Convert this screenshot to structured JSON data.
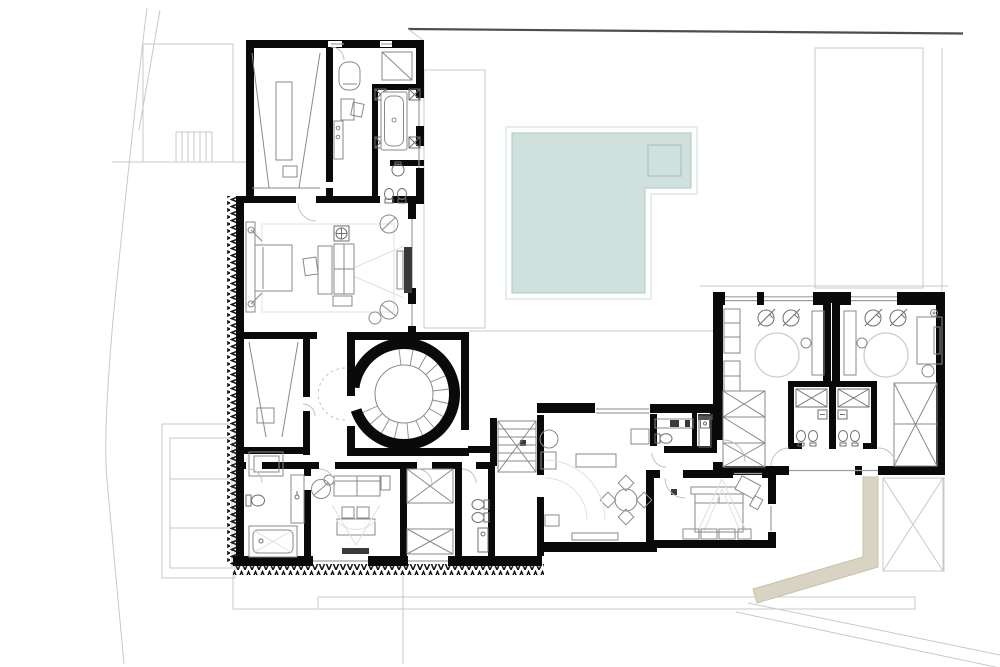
{
  "canvas": {
    "width": 1000,
    "height": 667,
    "background": "#ffffff"
  },
  "colors": {
    "wall": "#0a0a0a",
    "furniture": "#8a8a8a",
    "fixture": "#6f6f6f",
    "rug": "#e0e0e0",
    "site": "#c9c9c9",
    "site_wall": "#4d4d4d",
    "glass": "#9aa0a0",
    "pool_fill": "#cfe0dd",
    "pool_edge": "#b7cecb",
    "pool_halo": "#e4eeec",
    "spa_edge": "#aac6c2",
    "terrace_fill": "#d9d3c3",
    "terrace_edge": "#c7c0ab",
    "hatch": "#161616",
    "dark_fixture": "#3a3a3a",
    "background": "#ffffff"
  },
  "plan": {
    "type": "architectural floor plan",
    "features": [
      "site-boundary",
      "exterior-staircase",
      "lawn",
      "pool-deck",
      "planter-strip",
      "swimming-pool",
      "spa",
      "home-cinema",
      "corridor",
      "bathtub-room",
      "wc",
      "master-bedroom",
      "spiral-staircase",
      "walk-in-closet",
      "hall",
      "bathroom",
      "sitting-room",
      "wardrobe",
      "secondary-staircase",
      "family-room",
      "guest-bedroom",
      "twin-bathroom-suite-left",
      "twin-bathroom-suite-right",
      "sunken-terrace",
      "skylight",
      "retaining-wall-hatch"
    ]
  }
}
